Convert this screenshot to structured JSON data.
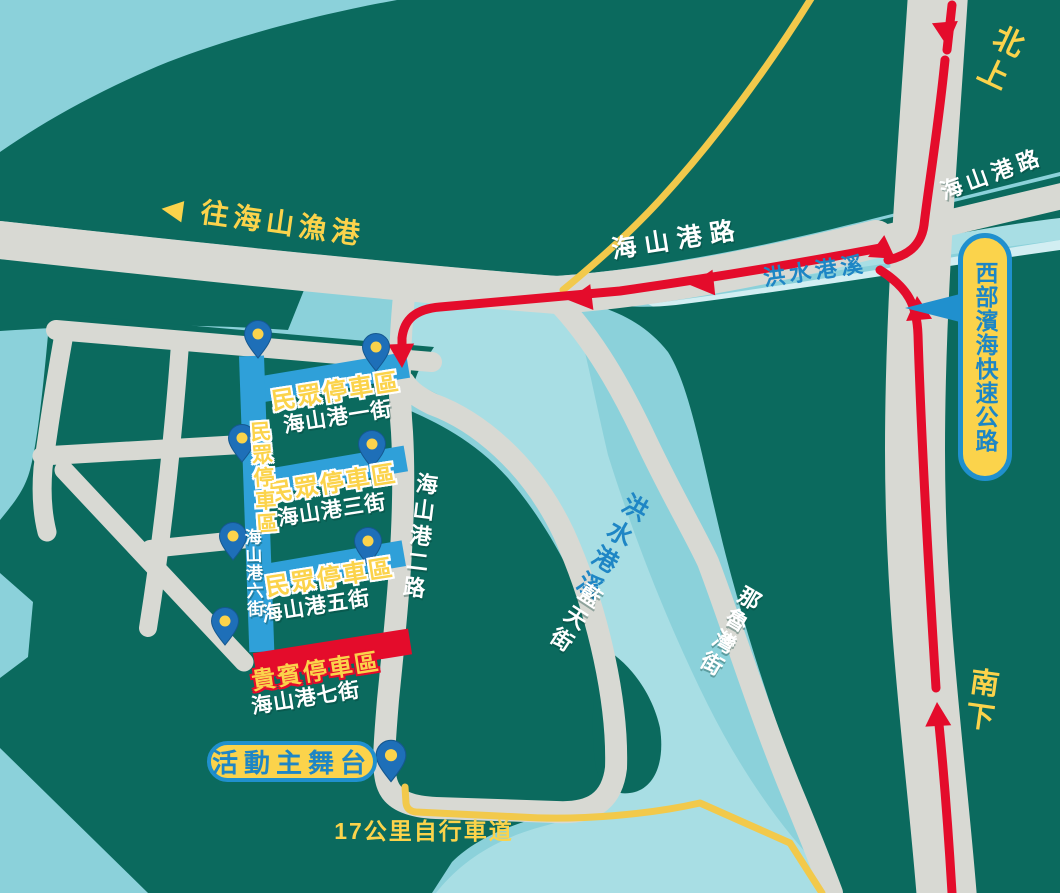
{
  "map": {
    "directions": {
      "north_label": "北上",
      "south_label": "南下"
    },
    "roads": {
      "haishangang_rd_main": "海山港路",
      "haishangang_rd_upper": "海山港路",
      "haishangang_2nd_rd": "海山港二路",
      "lantian_st": "藍天街",
      "naluwan_st": "那魯灣街"
    },
    "expressway": {
      "name": "西部濱海快速公路"
    },
    "river": {
      "name": "洪水港溪",
      "name_upper": "洪水港溪"
    },
    "poi": {
      "fishing_port_arrow": "◀",
      "fishing_port": "往海山漁港",
      "main_stage": "活動主舞台",
      "bike_trail": "17公里自行車道"
    },
    "parking": {
      "areas": [
        {
          "type": "public",
          "label": "民眾停車區",
          "street": "海山港一街"
        },
        {
          "type": "public",
          "label": "民眾停車區",
          "street": "海山港三街"
        },
        {
          "type": "public",
          "label": "民眾停車區",
          "street": "海山港五街"
        },
        {
          "type": "public",
          "label": "民眾停車區",
          "street": "海山港六街"
        },
        {
          "type": "vip",
          "label": "貴賓停車區",
          "street": "海山港七街"
        }
      ]
    },
    "colors": {
      "land": "#0B6A5E",
      "water": "#8BD1DA",
      "river": "#A8DEE4",
      "river_highlight": "#D2EEF2",
      "road": "#D8D9D3",
      "route_red": "#E40C2B",
      "parking_blue": "#2FA0D9",
      "vip_red": "#E40C2B",
      "accent_yellow": "#FBD34B",
      "badge_border_blue": "#2090CE",
      "badge_text_blue": "#1E86C5",
      "pin_blue": "#1E6FB8"
    }
  }
}
